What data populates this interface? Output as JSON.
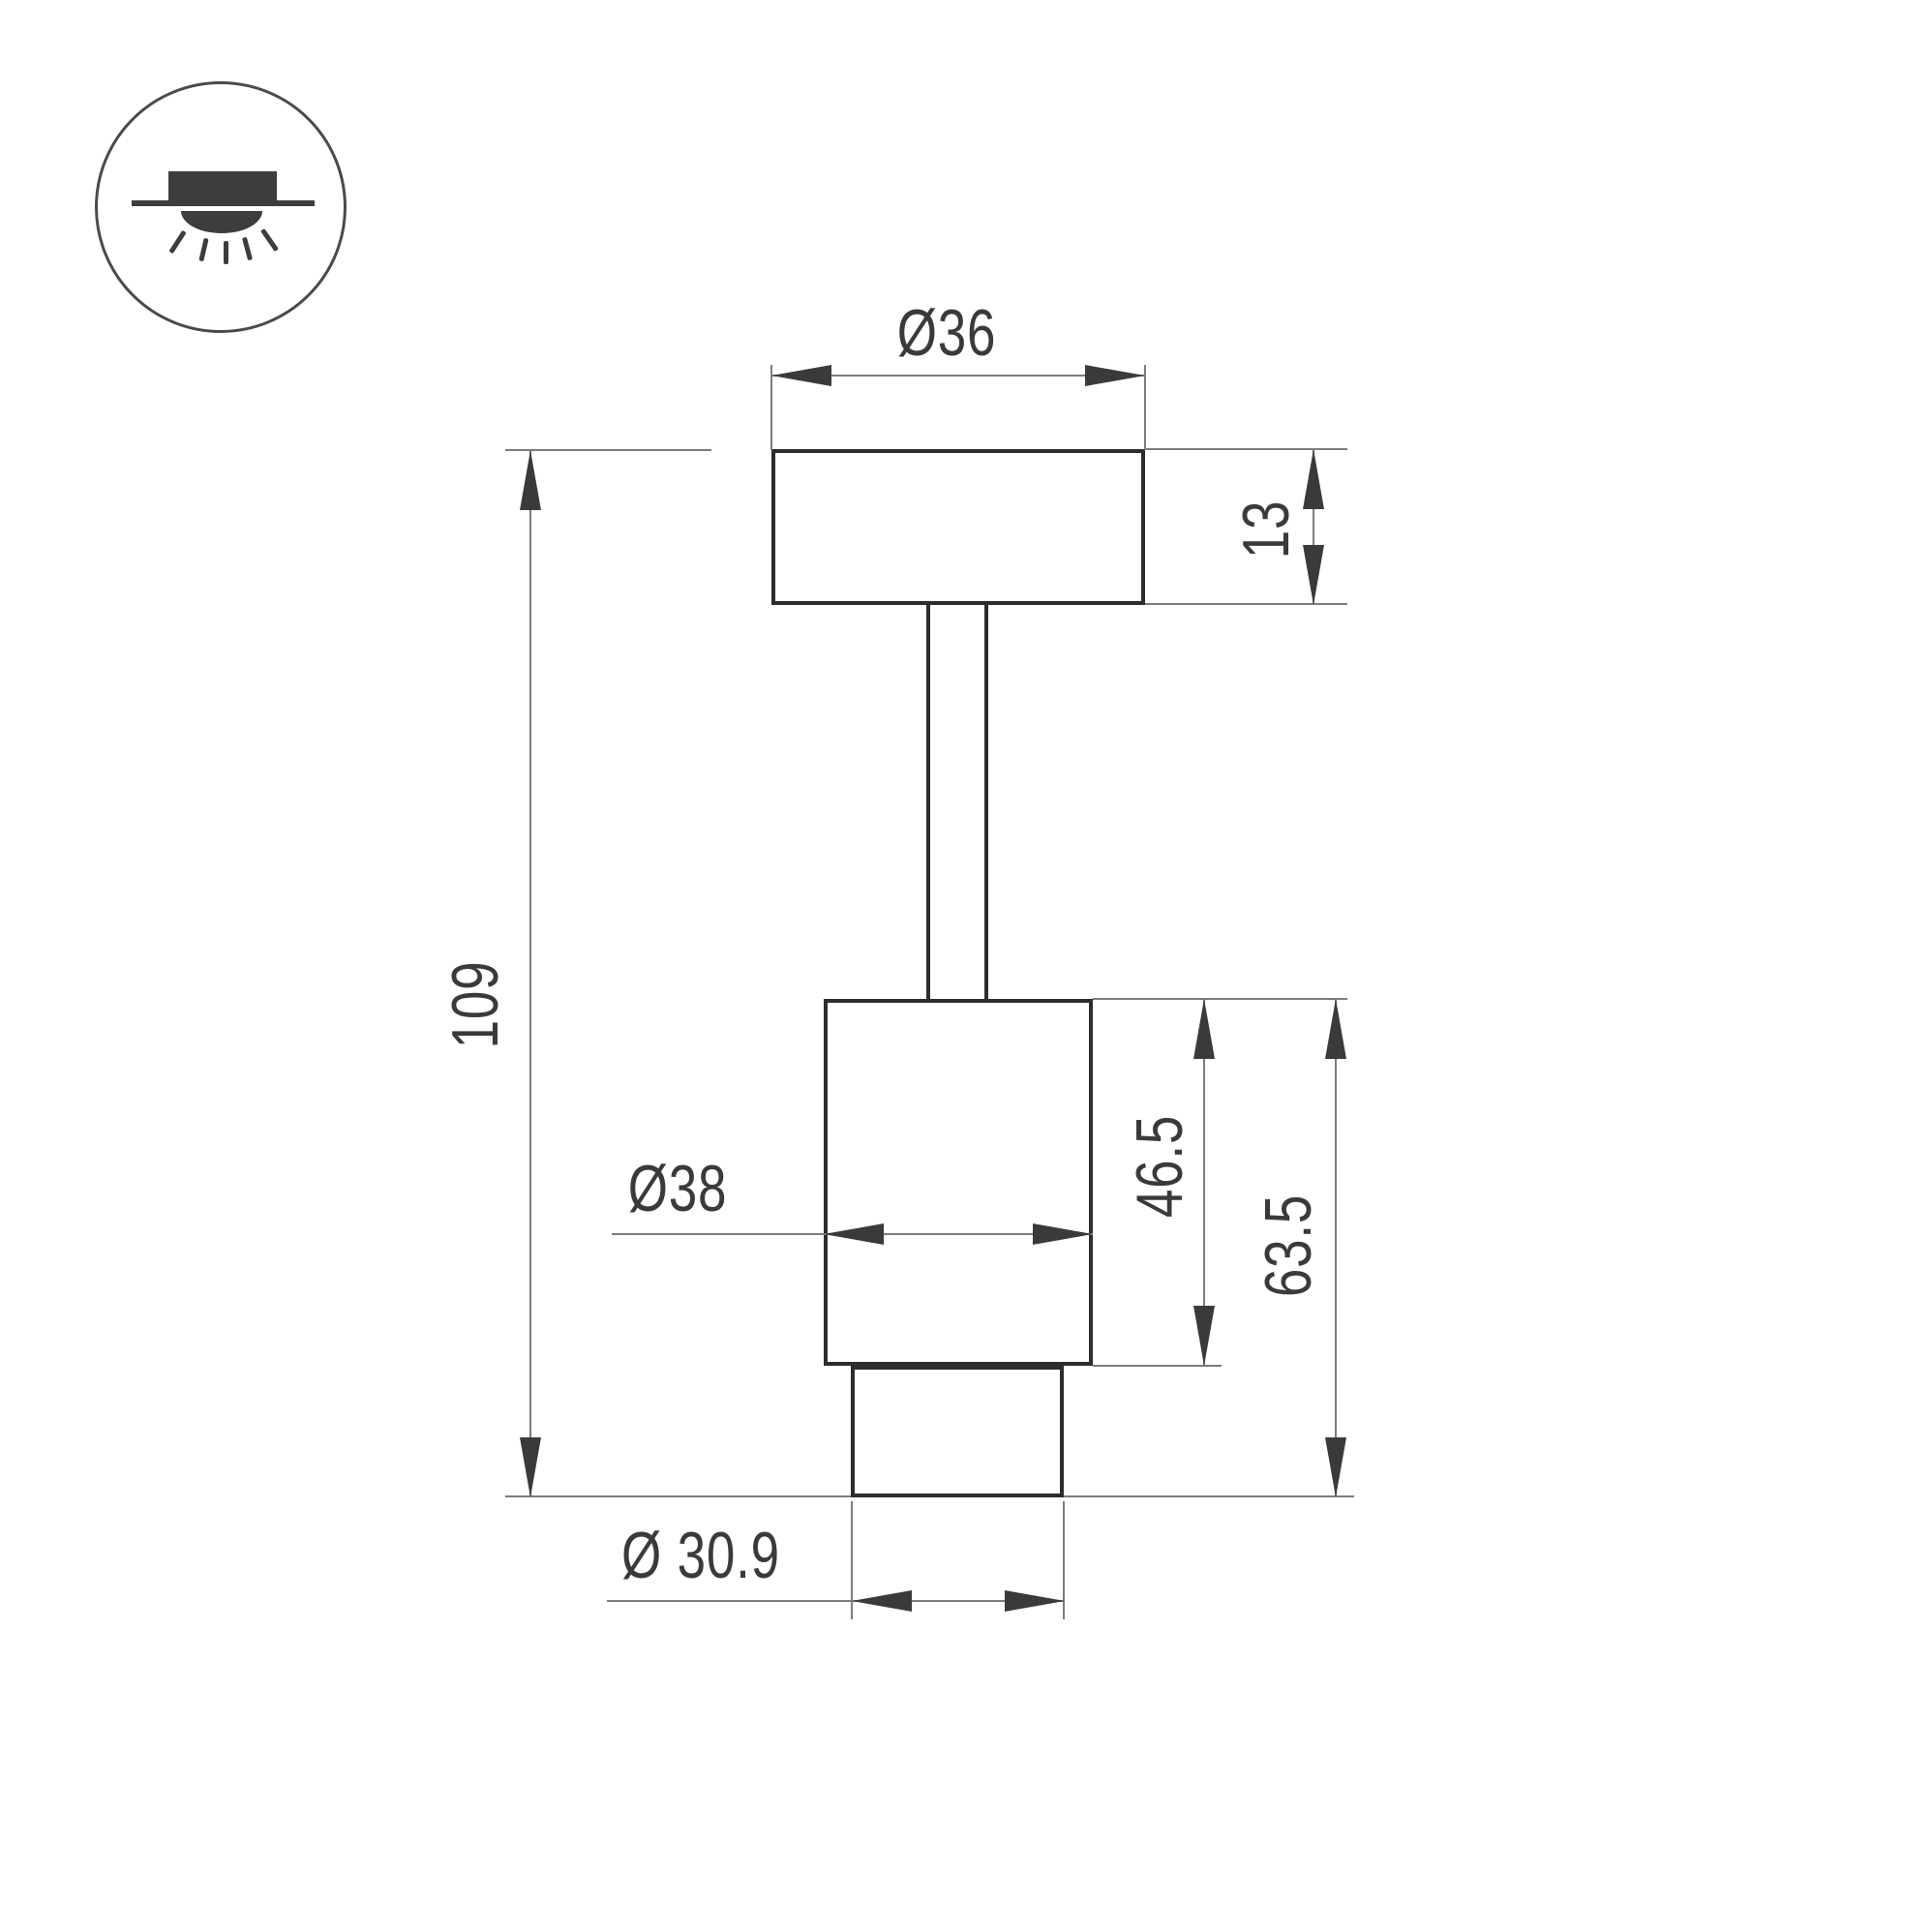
{
  "page": {
    "background": "#ffffff"
  },
  "icon": {
    "type": "surface-mounted-downlight",
    "description": "ceiling-mounted light symbol: canopy above ceiling line with glowing dome below"
  },
  "colors": {
    "object_line": "#2d2d2d",
    "dim_line": "#7d7d7d",
    "arrow": "#3a3a3a",
    "text": "#3a3a3a",
    "icon_fill": "#3d3d3d",
    "icon_outline": "#4a4a4a"
  },
  "dimensions": {
    "plate_diameter": "Ø36",
    "plate_height": "13",
    "overall_height": "109",
    "body_diameter": "Ø38",
    "body_height": "46.5",
    "lower_section_height": "63.5",
    "bottom_diameter": "Ø 30.9"
  }
}
